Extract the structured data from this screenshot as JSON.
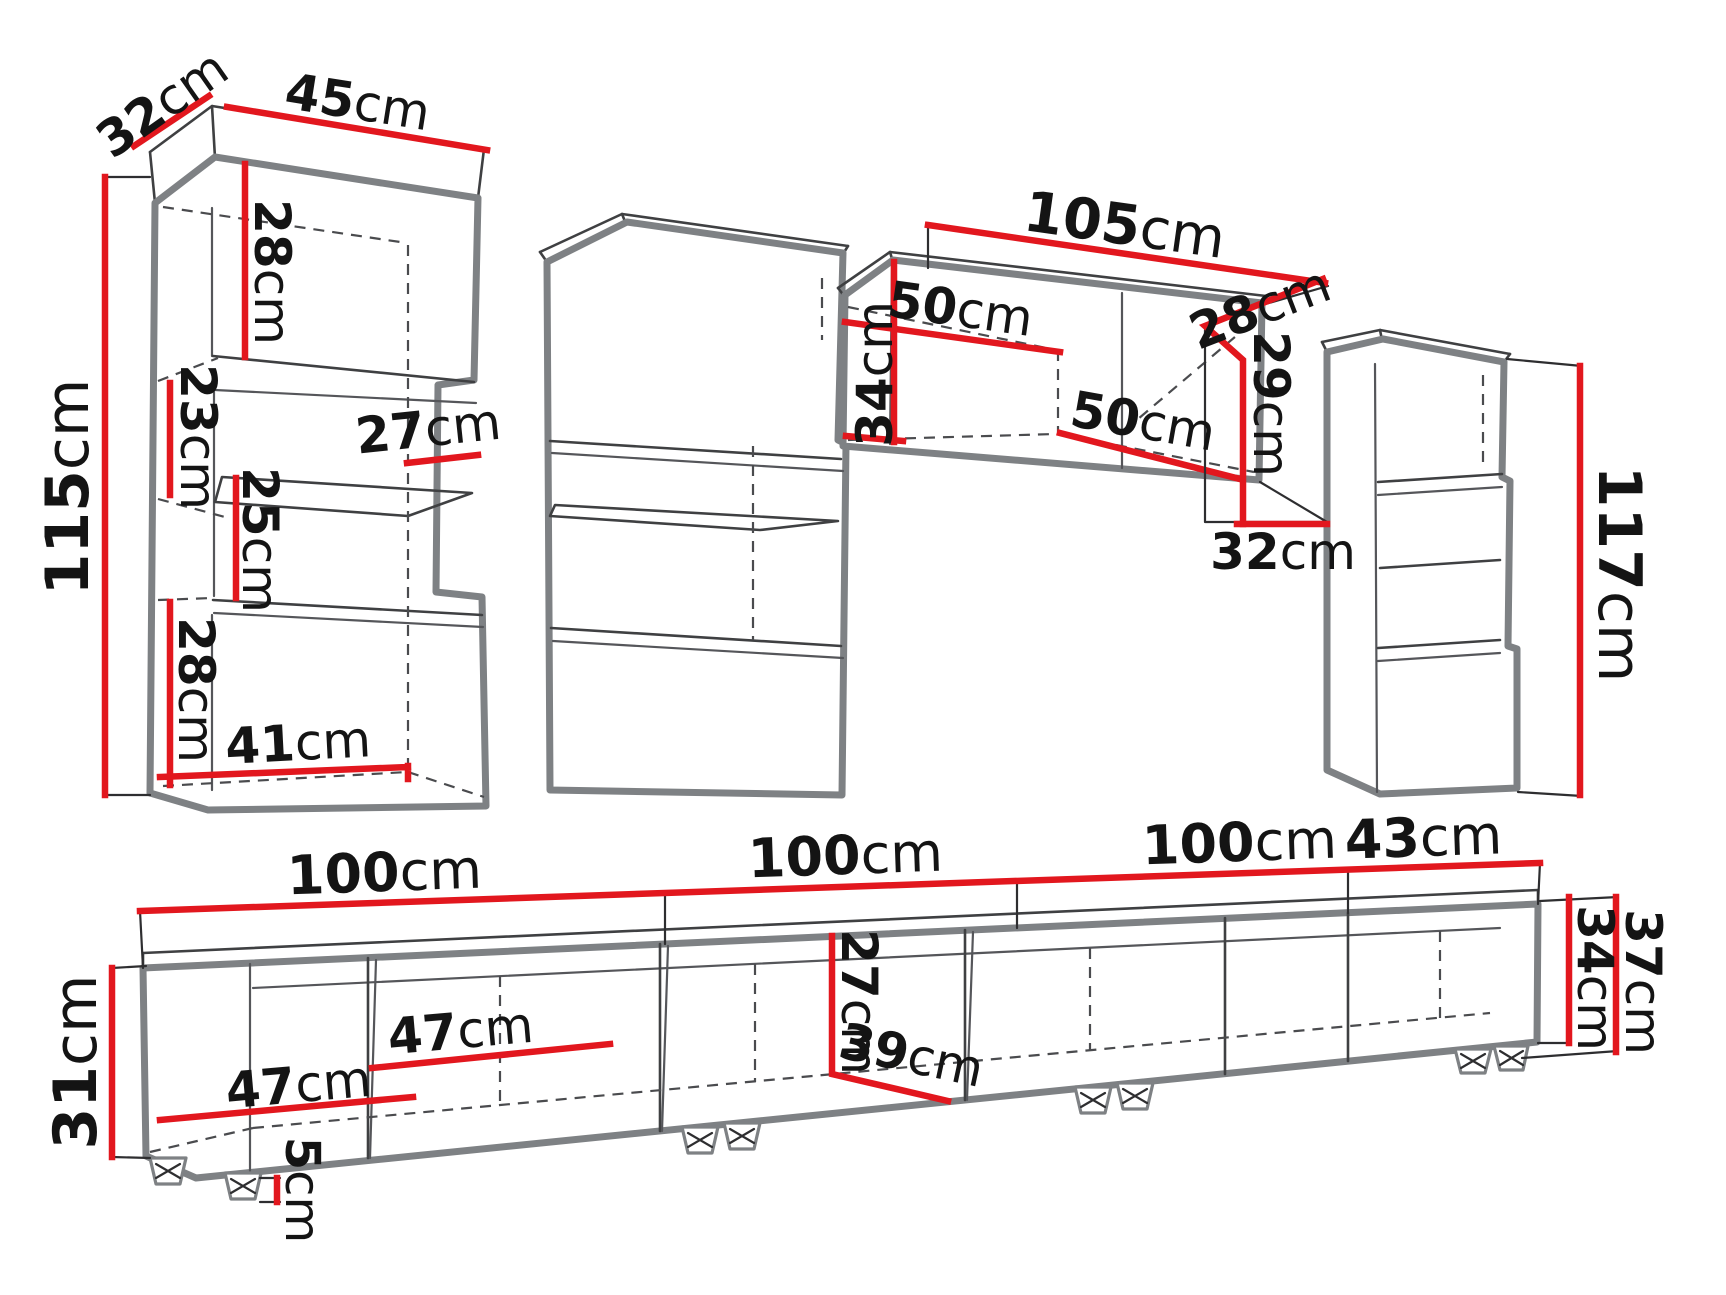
{
  "diagram": {
    "unit": "cm",
    "colors": {
      "dimension_line": "#e2171e",
      "furniture_outline": "#7e8184",
      "detail_line": "#3f4042",
      "label_text": "#141414",
      "background": "#ffffff"
    },
    "pieces": {
      "left_cabinet": {
        "depth": "32",
        "width": "45",
        "height": "115",
        "top_section_height": "28",
        "upper_gap_height": "23",
        "shelf_depth": "27",
        "shelf_gap_height": "25",
        "bottom_section_height": "28",
        "inner_width": "41"
      },
      "wall_cabinet": {
        "width": "105",
        "left_inner_width": "50",
        "right_inner_width": "50",
        "front_height": "34",
        "top_depth": "28",
        "end_height": "29",
        "end_depth": "32"
      },
      "right_cabinet": {
        "height": "117"
      },
      "tv_stand": {
        "module_1_width": "100",
        "module_2_width": "100",
        "module_3_width": "100",
        "module_4_width": "43",
        "left_height": "31",
        "inner_width_1": "47",
        "inner_width_2": "47",
        "inner_height": "27",
        "inner_depth": "39",
        "leg_height": "5",
        "right_body_height": "34",
        "right_total_height": "37"
      }
    }
  }
}
